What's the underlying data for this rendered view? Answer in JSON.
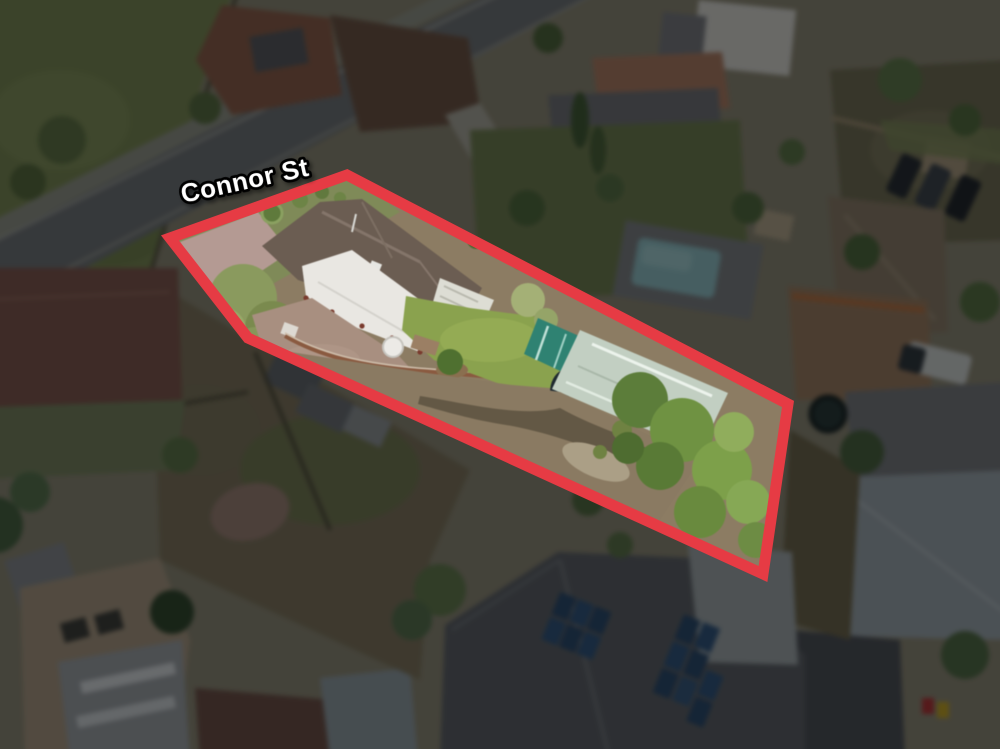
{
  "annotation": {
    "street_label": "Connor St"
  },
  "colors": {
    "boundary_outline": "#e63b44",
    "street_label_fill": "#ffffff",
    "street_label_outline": "#000000",
    "dim_overlay": "rgba(6,8,10,0.53)"
  }
}
